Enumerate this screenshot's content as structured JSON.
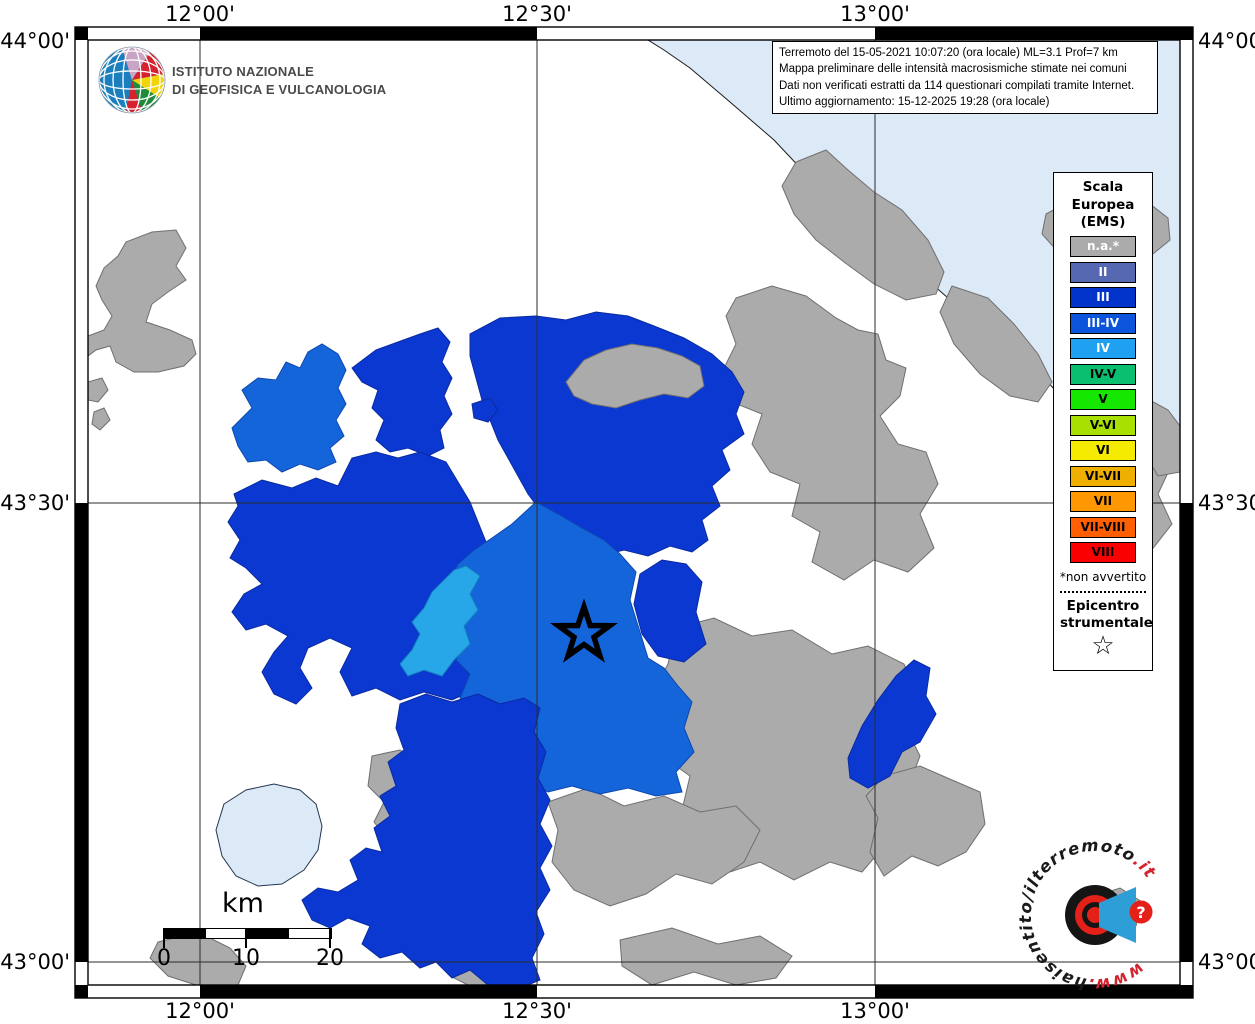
{
  "header": {
    "org_line1": "ISTITUTO NAZIONALE",
    "org_line2": "DI GEOFISICA E VULCANOLOGIA"
  },
  "info": {
    "lines": [
      "Terremoto del 15-05-2021 10:07:20 (ora locale) ML=3.1 Prof=7 km",
      "Mappa preliminare delle intensità macrosismiche stimate nei comuni",
      "Dati non verificati estratti da 114 questionari compilati tramite Internet.",
      "Ultimo aggiornamento: 15-12-2025 19:28 (ora locale)"
    ]
  },
  "legend": {
    "title": [
      "Scala",
      "Europea",
      "(EMS)"
    ],
    "items": [
      {
        "label": "n.a.*",
        "color": "#ABABAB",
        "text": "#FFFFFF"
      },
      {
        "label": "II",
        "color": "#5668B2",
        "text": "#FFFFFF"
      },
      {
        "label": "III",
        "color": "#0233CB",
        "text": "#FFFFFF"
      },
      {
        "label": "III-IV",
        "color": "#0A55DC",
        "text": "#FFFFFF"
      },
      {
        "label": "IV",
        "color": "#1FA0F0",
        "text": "#FFFFFF"
      },
      {
        "label": "IV-V",
        "color": "#0ABF70",
        "text": "#000000"
      },
      {
        "label": "V",
        "color": "#16E700",
        "text": "#000000"
      },
      {
        "label": "V-VI",
        "color": "#A8E000",
        "text": "#000000"
      },
      {
        "label": "VI",
        "color": "#F5EB00",
        "text": "#000000"
      },
      {
        "label": "VI-VII",
        "color": "#EFAF00",
        "text": "#000000"
      },
      {
        "label": "VII",
        "color": "#FF9800",
        "text": "#000000"
      },
      {
        "label": "VII-VIII",
        "color": "#FF5F00",
        "text": "#000000"
      },
      {
        "label": "VIII",
        "color": "#FA0000",
        "text": "#000000"
      }
    ],
    "footnote": "*non avvertito",
    "epicenter_label": [
      "Epicentro",
      "strumentale"
    ],
    "star": "☆"
  },
  "axes": {
    "top": [
      "12°00'",
      "12°30'",
      "13°00'"
    ],
    "bottom": [
      "12°00'",
      "12°30'",
      "13°00'"
    ],
    "left": [
      "44°00'",
      "43°30'",
      "43°00'"
    ],
    "right": [
      "44°00'",
      "43°30'",
      "43°00'"
    ]
  },
  "scalebar": {
    "unit": "km",
    "ticks": [
      "0",
      "10",
      "20"
    ]
  },
  "watermark": {
    "pre": "www.",
    "mid": "haisentito/ilterremoto",
    "suf": ".it",
    "q": "?"
  },
  "map": {
    "palette": {
      "sea": {
        "fill": "#DCEAF8",
        "stroke": "#1a1a1a"
      },
      "lake": {
        "fill": "#DCEAF8",
        "stroke": "#23364F"
      },
      "na": {
        "fill": "#ABABAB",
        "stroke": "#6F6F6F"
      },
      "iii": {
        "fill": "#0B38D0",
        "stroke": "#0A2AA0"
      },
      "iii_iv": {
        "fill": "#1565DA",
        "stroke": "#0D47B0"
      },
      "iv": {
        "fill": "#28A7E8",
        "stroke": "#1580C0"
      }
    },
    "grid": {
      "v": [
        200,
        537,
        875
      ],
      "h": [
        503,
        962
      ],
      "x0": 88,
      "x1": 1180,
      "y0": 40,
      "y1": 985
    },
    "epicenter": {
      "x": 584,
      "y": 634,
      "r_outer": 27,
      "r_inner": 10.5
    },
    "regions": [
      {
        "id": "adriatic-sea",
        "class": "sea",
        "points": "648,40 1180,40 1180,458 1158,468 1128,446 1096,424 1062,398 1030,362 1002,340 964,312 932,284 900,260 870,230 840,202 806,174 774,140 730,102 690,68 664,50"
      },
      {
        "id": "gray-nw",
        "class": "na",
        "points": "126,242 152,232 176,230 186,248 176,266 186,280 168,292 152,304 146,322 170,330 192,340 196,354 184,366 158,372 134,372 116,362 110,346 96,350 88,356 88,336 104,330 112,316 102,300 96,286 104,268 118,256"
      },
      {
        "id": "gray-islet-1",
        "class": "na",
        "points": "88,382 102,378 108,390 98,402 88,400"
      },
      {
        "id": "gray-islet-2",
        "class": "na",
        "points": "94,412 104,408 110,420 100,430 92,424"
      },
      {
        "id": "gray-coast-1",
        "class": "na",
        "points": "796,162 826,150 848,170 874,192 902,210 928,240 944,272 936,294 906,300 874,284 844,262 816,240 794,214 782,186"
      },
      {
        "id": "gray-coast-2",
        "class": "na",
        "points": "952,286 988,298 1014,324 1038,354 1052,382 1038,402 1010,396 980,374 954,344 940,312"
      },
      {
        "id": "gray-ne-arm",
        "class": "na",
        "points": "1046,214 1076,198 1104,204 1128,214 1150,204 1168,218 1170,240 1148,258 1118,252 1088,262 1058,252 1042,234"
      },
      {
        "id": "gray-right-big",
        "class": "na",
        "points": "736,298 772,286 806,296 836,318 858,330 878,334 886,360 906,368 900,396 880,416 898,444 926,452 938,484 920,514 934,548 908,572 874,560 844,580 812,562 820,532 792,516 800,484 770,472 752,444 762,414 732,402 722,372 736,344 726,316"
      },
      {
        "id": "gray-east",
        "class": "na",
        "points": "1090,428 1124,418 1156,436 1172,464 1158,494 1172,524 1150,552 1118,544 1094,558 1072,540 1084,508 1070,482 1088,456"
      },
      {
        "id": "gray-coast-3",
        "class": "na",
        "points": "1146,398 1168,410 1180,426 1180,472 1158,476 1144,452 1152,426 1138,410"
      },
      {
        "id": "gray-right-lower",
        "class": "na",
        "points": "676,628 714,618 752,636 792,630 832,654 868,646 904,664 915,690 905,726 920,756 908,788 880,806 886,844 862,872 830,862 794,880 760,862 730,872 706,856 714,828 682,810 690,776 662,756 672,722 652,694 668,664"
      },
      {
        "id": "gray-south-band",
        "class": "na",
        "points": "548,802 588,788 624,806 664,796 700,812 736,806 760,830 744,862 712,884 676,874 646,894 610,906 574,890 552,862 558,830"
      },
      {
        "id": "gray-south-low",
        "class": "na",
        "points": "620,940 672,928 718,944 760,936 792,956 776,978 736,985 694,972 652,985 622,966"
      },
      {
        "id": "gray-bottom-left",
        "class": "na",
        "points": "158,942 198,932 230,948 246,966 238,985 196,985 168,976 150,958"
      },
      {
        "id": "gray-bottom-mid",
        "class": "na",
        "points": "452,962 492,952 524,962 534,978 518,985 468,985 450,976"
      },
      {
        "id": "gray-se",
        "class": "na",
        "points": "884,776 920,766 952,780 980,792 985,824 966,852 938,866 912,856 884,876 870,852 878,818 866,796"
      },
      {
        "id": "gray-se-2",
        "class": "na",
        "points": "1090,898 1120,888 1142,902 1136,926 1110,936 1088,922"
      },
      {
        "id": "gray-lake-strip",
        "class": "na",
        "points": "372,756 400,750 420,764 410,788 428,808 414,830 426,852 410,874 422,894 402,908 384,898 392,876 378,862 388,840 374,822 384,802 368,786"
      },
      {
        "id": "blue-center-north",
        "class": "iii",
        "points": "470,334 500,318 536,316 566,320 596,312 628,316 654,326 684,338 712,354 732,372 744,392 736,414 744,434 722,450 730,470 712,486 720,506 702,520 708,540 692,552 670,546 648,556 624,550 600,556 578,550 562,542 552,524 540,510 528,494 518,476 508,458 498,440 490,420 482,400 476,378 470,356"
      },
      {
        "id": "gray-inset-north",
        "class": "na",
        "points": "566,382 584,360 606,350 632,344 658,348 682,356 700,366 704,386 688,398 664,394 640,400 616,408 592,404 574,396"
      },
      {
        "id": "blue-tall-nw",
        "class": "iii",
        "points": "352,368 376,350 398,342 420,334 438,328 450,342 442,362 452,378 444,396 452,414 440,430 444,448 428,456 408,448 390,452 376,440 384,420 372,408 378,390 362,382"
      },
      {
        "id": "blue-islet",
        "class": "iii",
        "points": "472,404 490,398 498,410 488,422 474,418"
      },
      {
        "id": "blue-west-big",
        "class": "iii",
        "points": "234,494 262,480 292,488 316,478 338,486 352,458 376,452 398,458 420,452 446,462 470,502 486,542 474,562 484,588 470,612 480,640 466,664 474,690 452,700 424,692 400,700 376,688 352,696 340,672 352,648 330,638 308,648 300,668 312,688 296,704 274,694 262,672 274,652 288,636 266,624 246,630 232,612 244,594 262,584 246,568 230,558 240,540 228,522 238,506"
      },
      {
        "id": "medblue-nw",
        "class": "iii_iv",
        "points": "232,428 252,408 242,390 258,378 276,380 286,362 300,368 308,352 322,344 338,354 346,370 338,388 346,404 336,420 344,436 330,448 336,462 318,470 300,464 282,472 266,460 248,462 238,446"
      },
      {
        "id": "medblue-central",
        "class": "iii_iv",
        "points": "536,502 558,514 582,528 604,540 620,554 636,572 630,600 640,632 648,658 664,668 678,686 692,702 684,728 694,752 676,772 682,792 656,796 628,788 600,794 572,786 548,792 524,780 500,786 480,770 488,746 470,734 478,710 460,698 470,674 456,660 466,634 452,620 462,598 448,584 458,564 474,550 492,538 512,524"
      },
      {
        "id": "blue-east-of-star",
        "class": "iii",
        "points": "640,574 662,560 686,564 702,582 696,612 706,644 684,662 658,656 642,634 634,604"
      },
      {
        "id": "blue-east",
        "class": "iii",
        "points": "848,758 862,726 878,700 896,676 914,660 930,668 926,696 936,714 920,742 902,752 890,776 868,788 850,778"
      },
      {
        "id": "blue-south-big",
        "class": "iii",
        "points": "400,704 426,694 452,702 478,694 500,704 524,698 540,708 534,732 546,752 538,778 550,800 540,824 552,846 540,868 550,890 536,912 544,934 532,958 540,980 528,985 488,985 470,970 452,978 436,962 420,968 402,952 380,958 362,944 370,926 348,918 330,928 312,920 302,900 318,888 338,892 358,880 350,860 366,848 382,852 374,828 390,816 380,796 396,786 388,762 404,750 396,728"
      },
      {
        "id": "azure-sliver",
        "class": "iv",
        "points": "466,566 480,576 470,594 478,610 464,626 470,644 454,660 442,676 424,670 408,676 400,664 412,650 420,634 412,622 424,608 432,592 444,580 454,570"
      },
      {
        "id": "lake-trasimeno",
        "class": "lake",
        "points": "224,804 246,790 274,784 300,790 316,804 322,826 318,850 304,870 282,884 258,886 236,876 222,856 216,830"
      }
    ]
  }
}
